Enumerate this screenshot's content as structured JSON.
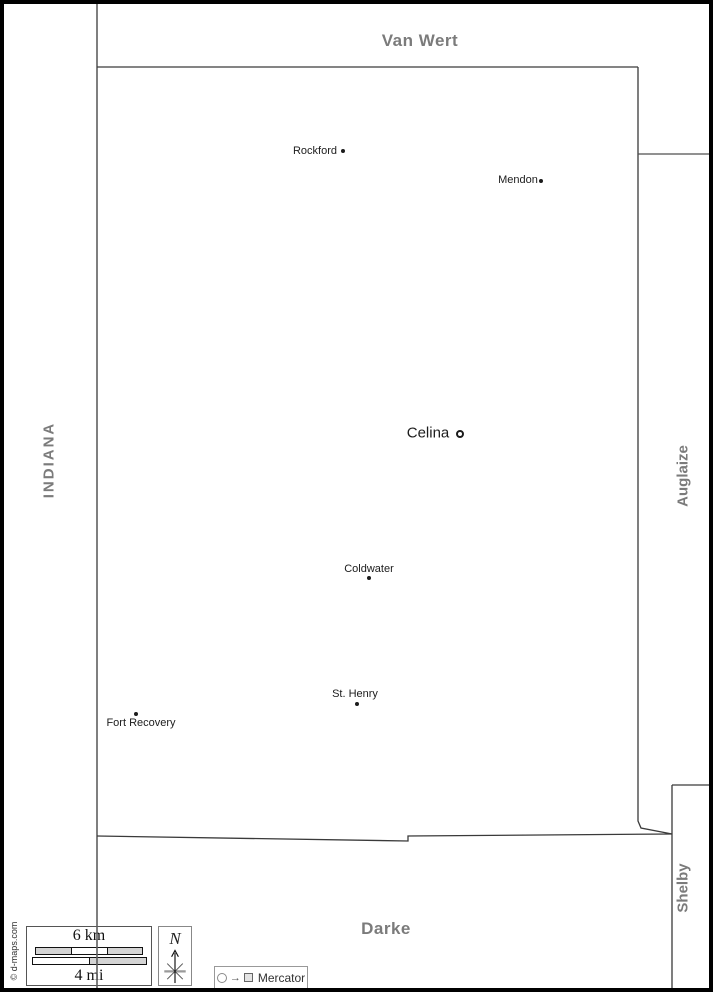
{
  "neighbors": {
    "north": "Van Wert",
    "west_state": "INDIANA",
    "east": "Auglaize",
    "southeast": "Shelby",
    "south": "Darke"
  },
  "cities": [
    {
      "name": "Rockford",
      "marker": "dot",
      "large": false,
      "label_x": 311,
      "label_y": 147,
      "dot_x": 339,
      "dot_y": 147
    },
    {
      "name": "Mendon",
      "marker": "dot",
      "large": false,
      "label_x": 514,
      "label_y": 176,
      "dot_x": 537,
      "dot_y": 177
    },
    {
      "name": "Celina",
      "marker": "ring",
      "large": true,
      "label_x": 424,
      "label_y": 429,
      "dot_x": 456,
      "dot_y": 430
    },
    {
      "name": "Coldwater",
      "marker": "dot",
      "large": false,
      "label_x": 365,
      "label_y": 565,
      "dot_x": 365,
      "dot_y": 574
    },
    {
      "name": "St. Henry",
      "marker": "dot",
      "large": false,
      "label_x": 351,
      "label_y": 690,
      "dot_x": 353,
      "dot_y": 700
    },
    {
      "name": "Fort Recovery",
      "marker": "dot",
      "large": false,
      "label_x": 137,
      "label_y": 719,
      "dot_x": 132,
      "dot_y": 710
    }
  ],
  "scale": {
    "km_label": "6 km",
    "mi_label": "4 mi"
  },
  "compass": {
    "north_label": "N"
  },
  "projection": {
    "label": "Mercator"
  },
  "credit": "© d-maps.com",
  "colors": {
    "neighbor_label": "#7b7b7b",
    "city_text": "#1c1c1c",
    "county_boundary": "#3a3a3a",
    "state_line": "#5f5f5f"
  }
}
